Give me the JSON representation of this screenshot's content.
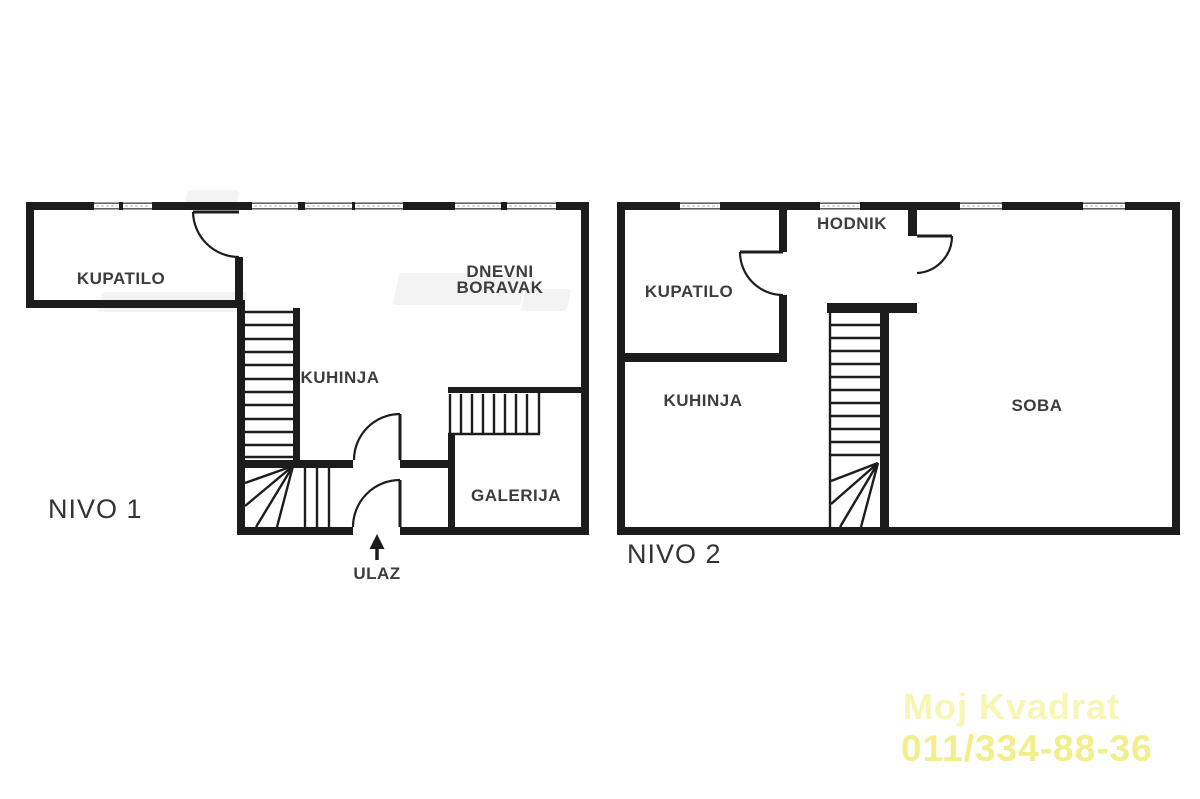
{
  "level1": {
    "label": "NIVO 1",
    "rooms": {
      "kupatilo": "KUPATILO",
      "kuhinja": "KUHINJA",
      "dnevni_boravak": "DNEVNI BORAVAK",
      "galerija": "GALERIJA"
    },
    "entrance": "ULAZ"
  },
  "level2": {
    "label": "NIVO 2",
    "rooms": {
      "kupatilo": "KUPATILO",
      "hodnik": "HODNIK",
      "kuhinja": "KUHINJA",
      "soba": "SOBA"
    }
  },
  "watermark": {
    "brand": "Moj Kvadrat",
    "phone": "011/334-88-36",
    "brand_color": "#f7f6b4",
    "phone_color": "#f1ee8b"
  },
  "colors": {
    "background": "#ffffff",
    "wall": "#1c1c1c",
    "label_text": "#3d3d3d"
  }
}
